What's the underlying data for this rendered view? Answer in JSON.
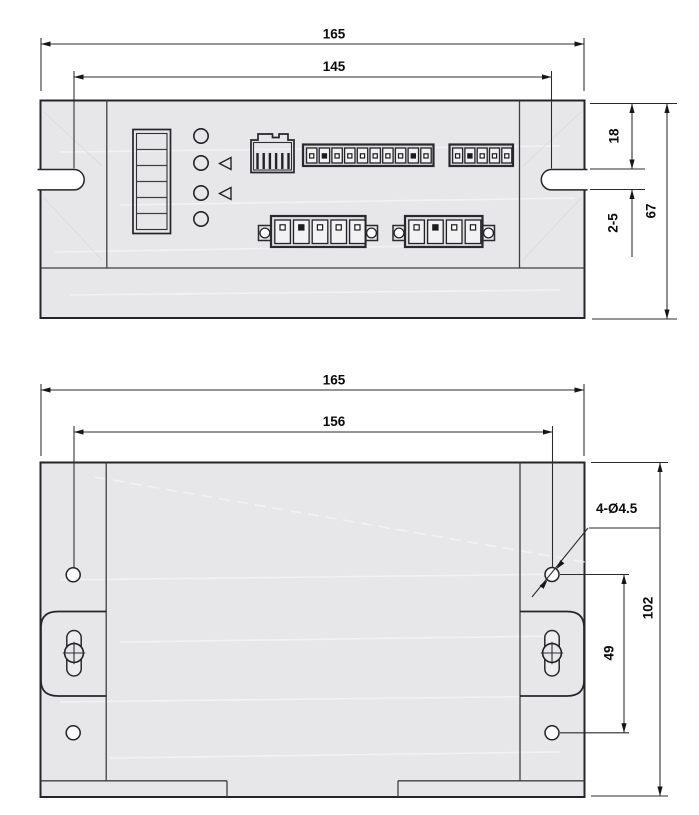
{
  "drawing_type": "dimension-drawing",
  "front_view": {
    "dims": {
      "overall_width": "165",
      "mount_slot_spacing": "145",
      "top_to_slot": "18",
      "panel_thickness_range": "2-5",
      "overall_height": "67"
    },
    "components": {
      "dip_switch_positions": 6,
      "led_count": 4,
      "indicator_triangles": 2,
      "rj45_pins": 6,
      "terminal_row_1": {
        "pins": 10,
        "solid_dots": [
          1,
          8
        ]
      },
      "terminal_row_2": {
        "pins": 5,
        "solid_dots": [
          1
        ]
      },
      "power_block_1": {
        "pins": 5,
        "solid_dots": [
          1
        ]
      },
      "power_block_2": {
        "pins": 4,
        "solid_dots": [
          1
        ]
      }
    }
  },
  "bottom_view": {
    "dims": {
      "overall_width": "165",
      "hole_spacing_horizontal": "156",
      "hole_callout": "4-Ø4.5",
      "overall_height": "102",
      "hole_spacing_vertical": "49"
    },
    "mounting_holes": 4,
    "mounting_screws": 2
  }
}
